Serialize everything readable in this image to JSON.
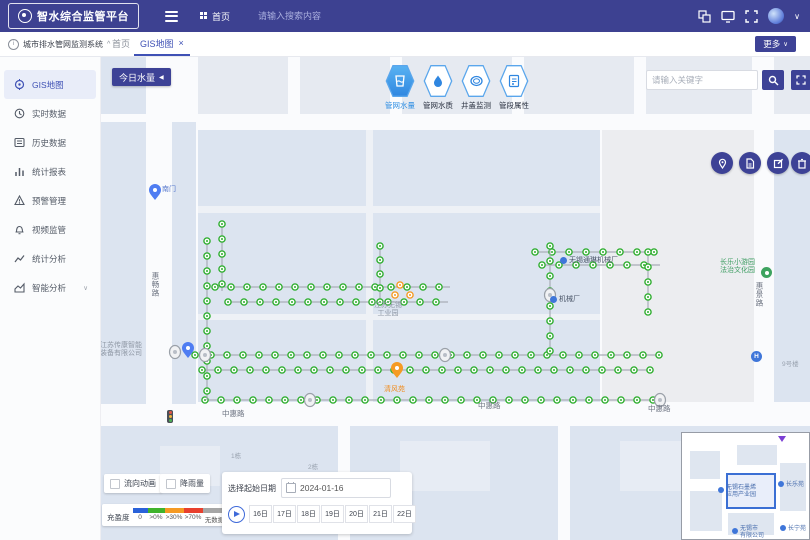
{
  "header": {
    "logo": "智水综合监管平台",
    "menu": "首页",
    "search_placeholder": "请输入搜索内容"
  },
  "tabbar": {
    "system_title": "城市排水管网监测系统",
    "tabs": [
      {
        "label": "首页"
      },
      {
        "label": "GIS地图"
      }
    ],
    "more": "更多"
  },
  "icons": {
    "close": "×",
    "chevron_down": "∨",
    "collapse_caret": "^",
    "today_caret": "◀",
    "expand_caret": "∨",
    "info": "i"
  },
  "sidebar": {
    "items": [
      {
        "label": "GIS地图"
      },
      {
        "label": "实时数据"
      },
      {
        "label": "历史数据"
      },
      {
        "label": "统计报表"
      },
      {
        "label": "预警管理"
      },
      {
        "label": "视频监管"
      },
      {
        "label": "统计分析"
      },
      {
        "label": "智能分析"
      }
    ]
  },
  "map": {
    "today_button": "今日水量",
    "layers": [
      {
        "label": "管网水量",
        "active": true
      },
      {
        "label": "管网水质",
        "active": false
      },
      {
        "label": "井盖监测",
        "active": false
      },
      {
        "label": "管段属性",
        "active": false
      }
    ],
    "search_placeholder": "请输入关键字",
    "labels": {
      "road_left": "惠畅路",
      "road_right": "惠景路",
      "road_bottom": "中惠路",
      "south_gate": "南门",
      "industrial_line1": "江苏无锡",
      "industrial_line2": "工业园",
      "factory": "无锡通琳机械厂",
      "factory2": "机械厂",
      "park_line1": "长乐小游园",
      "park_line2": "法治文化园",
      "poi_orange": "清风苑",
      "company_line1": "江苏传康智能",
      "company_line2": "装备有限公司",
      "building1": "1栋",
      "building2": "2栋",
      "building3": "9号楼",
      "stop": "H"
    },
    "colors": {
      "node_green": "#2fae2f",
      "node_orange": "#f59a23",
      "pin_blue": "#4f7df2",
      "accent_indigo": "#3d4296",
      "active_blue": "#2f8fe3"
    }
  },
  "controls": {
    "flow_animation": "流向动画",
    "rainfall": "降雨量",
    "legend_title": "充盈度",
    "legend": [
      {
        "label": "0",
        "color": "#2a62d9"
      },
      {
        "label": ">0%",
        "color": "#3fb32b"
      },
      {
        "label": ">30%",
        "color": "#f59a23"
      },
      {
        "label": ">70%",
        "color": "#e8402d"
      },
      {
        "label": "无数据",
        "color": "#a6a6a6"
      }
    ],
    "date_label": "选择起始日期",
    "date_value": "2024-01-16",
    "days": [
      "16日",
      "17日",
      "18日",
      "19日",
      "20日",
      "21日",
      "22日"
    ]
  },
  "minimap": {
    "poi1_line1": "无锡石墨烯",
    "poi1_line2": "应用产业园",
    "poi2": "长乐苑",
    "poi3": "长宁苑",
    "poi4_line1": "无锡市",
    "poi4_line2": "有限公司"
  }
}
